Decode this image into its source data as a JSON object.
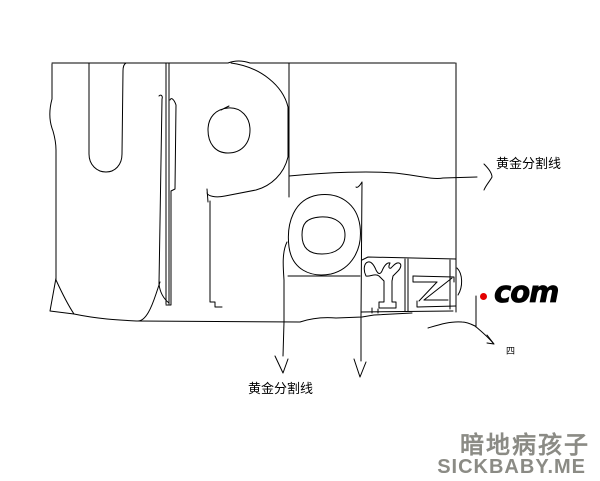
{
  "canvas": {
    "width": 600,
    "height": 481,
    "background_color": "#ffffff",
    "ink_color": "#000000",
    "description": "freehand pencil sketch of logo letters U P o Y Z with golden-ratio guide lines"
  },
  "sketch": {
    "letters": [
      "U",
      "P",
      "o",
      "Y",
      "Z"
    ]
  },
  "annotations": {
    "golden_line_right_label": "黄金分割线",
    "golden_line_bottom_label": "黄金分割线",
    "com_text": "com",
    "tiny_text": "四",
    "dot_color": "#e30000"
  },
  "watermark": {
    "line1": "暗地病孩子",
    "line2": "SICKBABY.ME",
    "color": "#8b8b85"
  }
}
